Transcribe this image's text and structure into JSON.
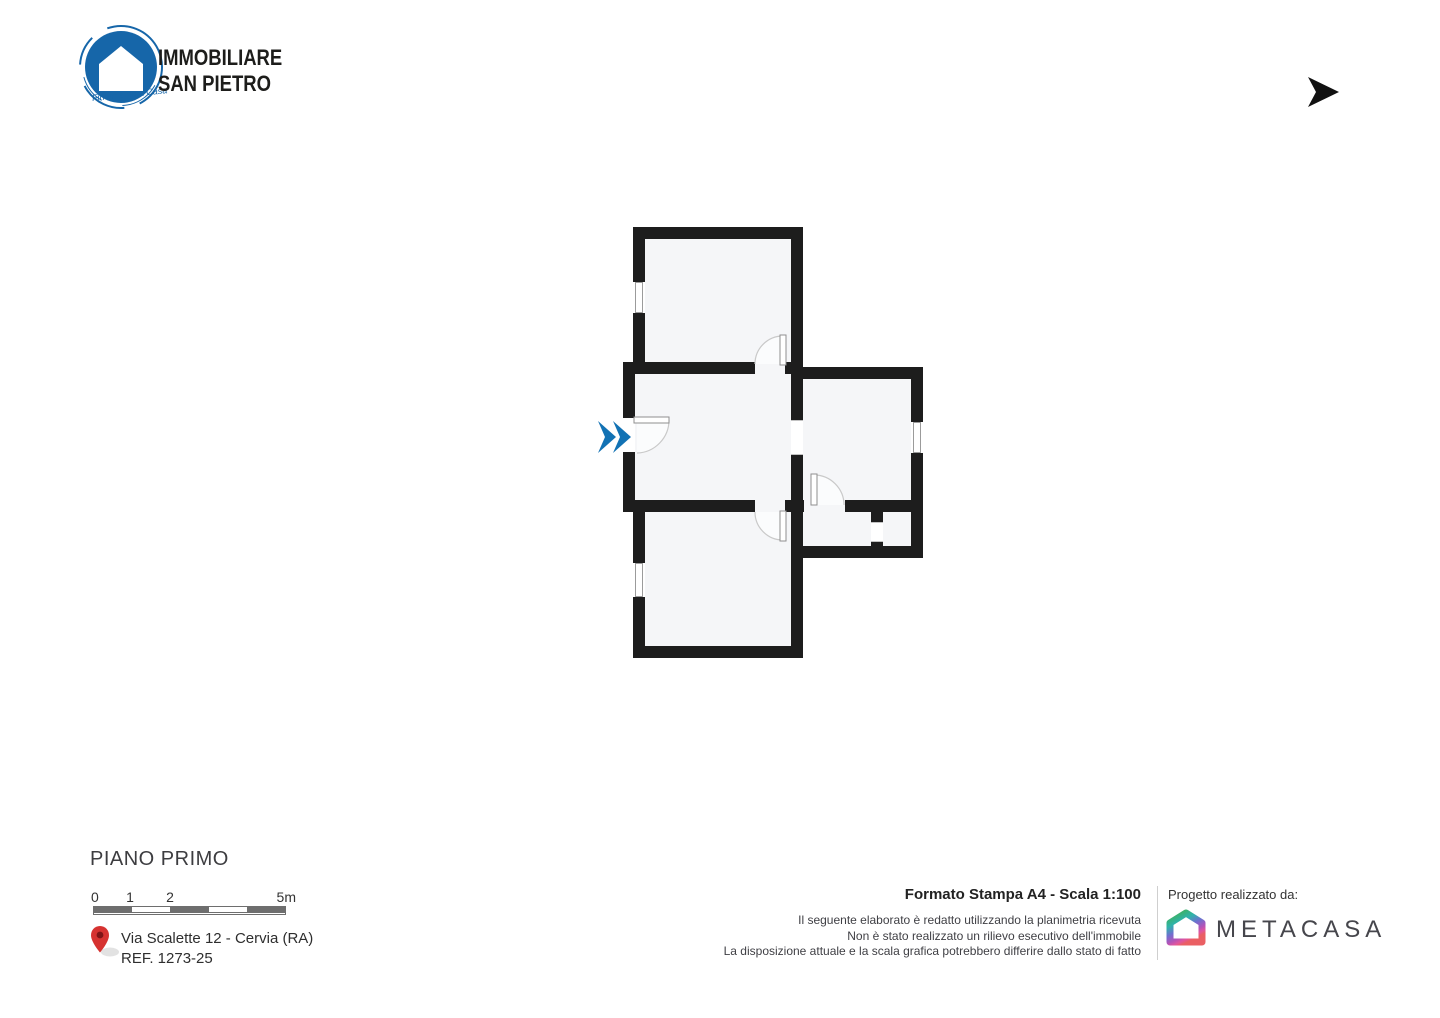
{
  "colors": {
    "wall": "#1d1d1d",
    "room_fill": "#f5f6f8",
    "entrance_blue": "#1272b4",
    "agency_blue": "#1666a9",
    "pin_red": "#d63230"
  },
  "header": {
    "agency_logo": {
      "icon": "house-in-circle-icon",
      "line1": "IMMOBILIARE",
      "line2": "SAN PIETRO",
      "tagline": "Finalmente a Casa"
    },
    "compass": {
      "icon": "north-arrow-icon",
      "letter": "N"
    }
  },
  "footer": {
    "floor_title": "PIANO PRIMO",
    "scalebar": {
      "labels": [
        "0",
        "1",
        "2",
        "5m"
      ]
    },
    "address": {
      "line1": "Via Scalette 12 - Cervia (RA)",
      "line2": "REF. 1273-25"
    },
    "print_info": {
      "title": "Formato Stampa A4 - Scala 1:100",
      "disclaimer": [
        "Il seguente elaborato è redatto utilizzando la planimetria ricevuta",
        "Non è stato realizzato un rilievo esecutivo dell'immobile",
        "La disposizione attuale e la scala grafica potrebbero differire dallo stato di fatto"
      ]
    },
    "credit": {
      "label": "Progetto realizzato da:",
      "brand": "METACASA"
    }
  }
}
